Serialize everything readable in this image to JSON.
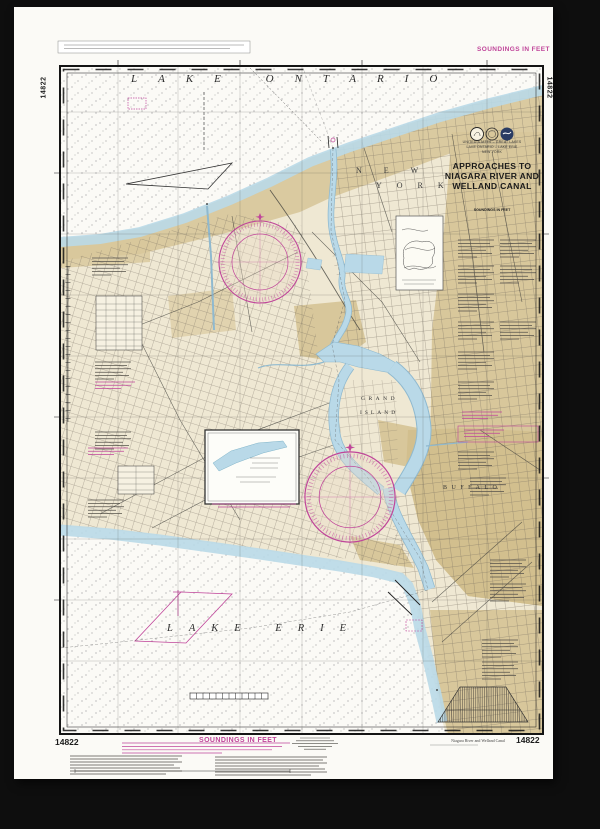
{
  "colors": {
    "magenta": "#c0459a",
    "tan": "#d8c79b",
    "blue": "#b9d9e8",
    "paper": "#efe8d3",
    "ink": "#1c1c1c"
  },
  "chart_number": "14822",
  "margins": {
    "top_right_soundings": "SOUNDINGS IN FEET",
    "bottom_soundings": "SOUNDINGS IN FEET",
    "left_vertical_number": "14822",
    "right_vertical_number": "14822",
    "bottom_left_number": "14822",
    "bottom_right_number": "14822",
    "bottom_right_caption": "Niagara River and Welland Canal"
  },
  "title_block": {
    "region_line1": "UNITED STATES – GREAT LAKES",
    "region_line2": "LAKE ONTARIO – LAKE ERIE",
    "region_line3": "NEW YORK",
    "title_line1": "APPROACHES TO",
    "title_line2": "NIAGARA RIVER AND",
    "title_line3": "WELLAND CANAL",
    "soundings_note": "SOUNDINGS IN FEET"
  },
  "map_labels": {
    "lake_ontario": "LAKE ONTARIO",
    "lake_erie": "LAKE ERIE",
    "state_word1": "NEW",
    "state_word2": "YORK",
    "island_word1": "GRAND",
    "island_word2": "ISLAND",
    "buffalo": "BUFFALO"
  }
}
